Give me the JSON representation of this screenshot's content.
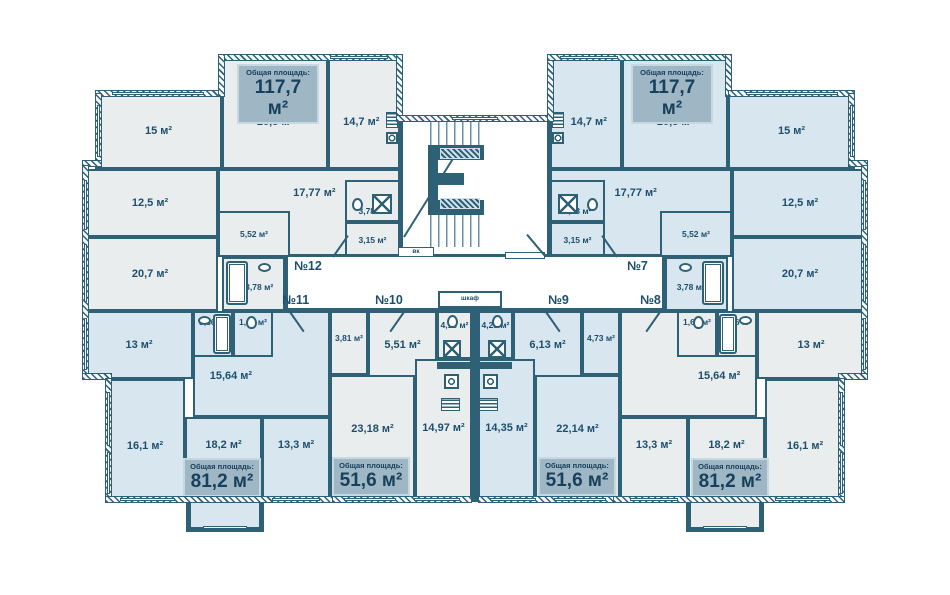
{
  "plan_title": "residential-floor-plan",
  "colors": {
    "wall": "#2e6076",
    "apartment_gray": "#eaedee",
    "apartment_blue": "#d8e7ef",
    "badge_background": "#9fb6c4",
    "label_text": "#1d4f6d"
  },
  "apartments": [
    {
      "number": "№12",
      "total_label": "Общая площадь:",
      "total_value": "117,7 м²",
      "rooms": [
        "15 м²",
        "20,8 м²",
        "14,7 м²",
        "12,5 м²",
        "17,77 м²",
        "5,52 м²",
        "3,78 м²",
        "3,15 м²",
        "20,7 м²",
        "3,78 м²"
      ]
    },
    {
      "number": "№7",
      "total_label": "Общая площадь:",
      "total_value": "117,7 м²",
      "rooms": [
        "14,7 м²",
        "20,8 м²",
        "15 м²",
        "17,77 м²",
        "3,78 м²",
        "3,15 м²",
        "5,52 м²",
        "12,5 м²",
        "20,7 м²",
        "3,78 м²"
      ]
    },
    {
      "number": "№11",
      "total_label": "Общая площадь:",
      "total_value": "81,2 м²",
      "rooms": [
        "13 м²",
        "3,36 м²",
        "1,60 м²",
        "15,64 м²",
        "16,1 м²",
        "18,2 м²",
        "13,3 м²"
      ]
    },
    {
      "number": "№10",
      "total_label": "Общая площадь:",
      "total_value": "51,6 м²",
      "rooms": [
        "3,81 м²",
        "5,51 м²",
        "4,13 м²",
        "23,18 м²",
        "14,97 м²"
      ]
    },
    {
      "number": "№9",
      "total_label": "Общая площадь:",
      "total_value": "51,6 м²",
      "rooms": [
        "4,25 м²",
        "6,13 м²",
        "4,73 м²",
        "14,35 м²",
        "22,14 м²"
      ]
    },
    {
      "number": "№8",
      "total_label": "Общая площадь:",
      "total_value": "81,2 м²",
      "rooms": [
        "1,60 м²",
        "3,36 м²",
        "13 м²",
        "15,64 м²",
        "13,3 м²",
        "18,2 м²",
        "16,1 м²"
      ]
    }
  ],
  "core": {
    "closet_label": "шкаф",
    "utility_label": "вк"
  }
}
